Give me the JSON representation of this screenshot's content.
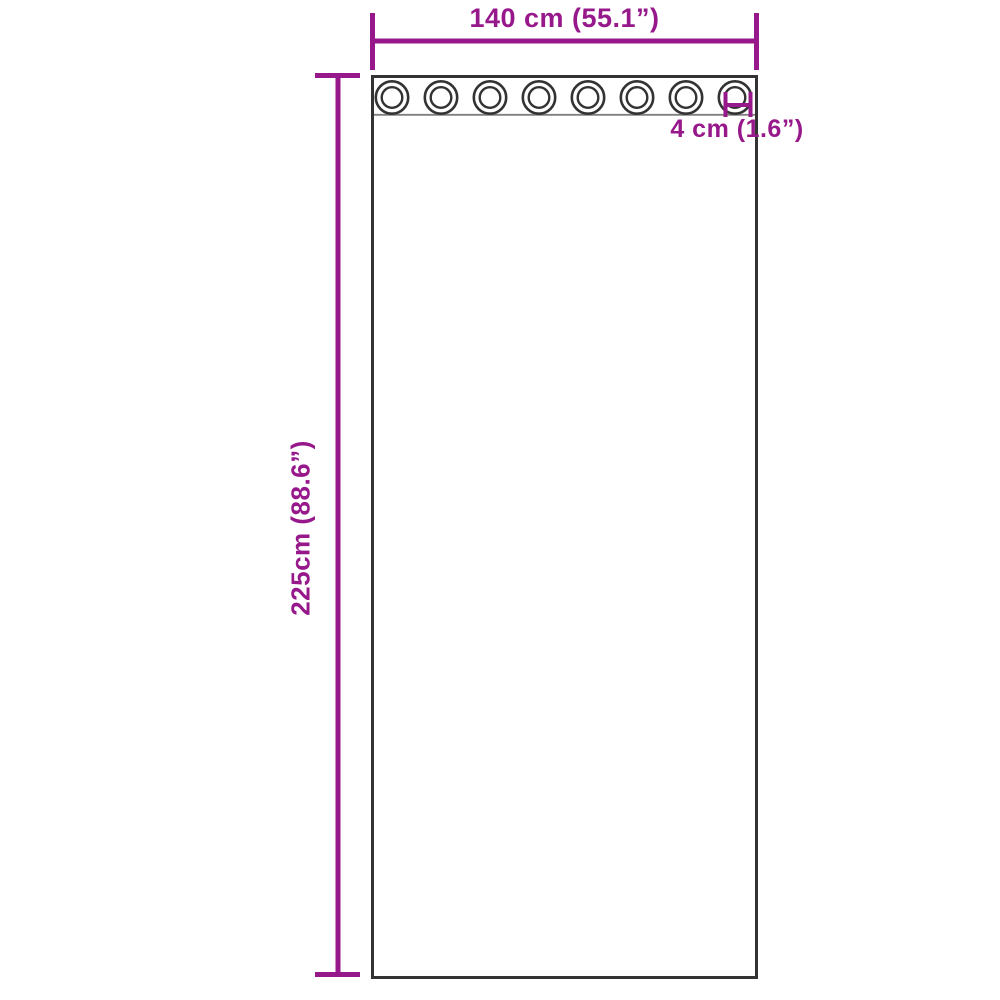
{
  "diagram": {
    "title": "curtain-with-grommets-dimension-diagram",
    "width_label": "140 cm (55.1”)",
    "height_label": "225cm (88.6”)",
    "grommet_label": "4 cm (1.6”)",
    "grommet_count": 8
  },
  "colors": {
    "dimension_accent": "#97188B",
    "outline": "#333333",
    "band_line": "#808080",
    "background": "#FFFFFF"
  }
}
